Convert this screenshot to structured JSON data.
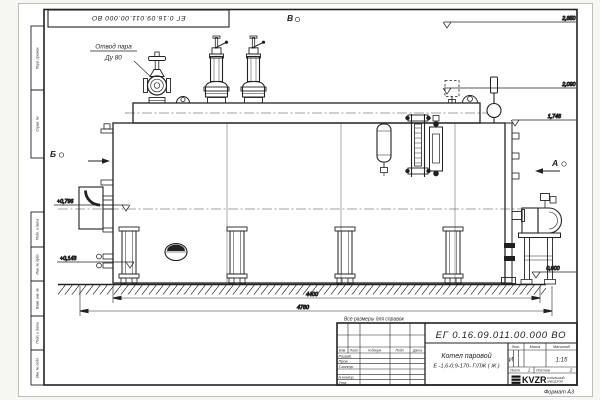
{
  "sheet": {
    "format_label": "Формат А3",
    "note": "Все размеры для справок"
  },
  "callouts": {
    "steam_outlet_line1": "Отвод пара",
    "steam_outlet_line2": "Ду 80"
  },
  "view_markers": {
    "top": "В",
    "left": "Б",
    "right": "А"
  },
  "elevations": {
    "valves_top": "2,850",
    "drum_top": "2,090",
    "shell_top": "1,746",
    "burner_axis": "+0,796",
    "drain": "+0,143",
    "floor": "0,000"
  },
  "dimensions": {
    "boiler_length": "4400",
    "overall_length": "4780"
  },
  "title_block": {
    "doc_number": "ЕГ 0.16.09.011.00.000  ВО",
    "product_line1": "Котел паровой",
    "product_line2": "Е -1,6-0,9-170- Г/ЛЖ ( Ж )",
    "col_headers": {
      "izm": "Изм.",
      "list": "Лист",
      "ndoc": "N докум.",
      "podp": "Подп.",
      "data": "Дата"
    },
    "rows": [
      "Разраб.",
      "Пров.",
      "Т.контр.",
      "",
      "Н.контр.",
      "Утв."
    ],
    "lit_label": "Лит.",
    "mass_label": "Масса",
    "scale_label": "Масштаб",
    "lit_value": "И",
    "scale_value": "1:15",
    "sheet_label": "Лист",
    "sheet_value": "1",
    "sheets_label": "Листов",
    "sheets_value": "2",
    "logo_text": "KVZR",
    "logo_line1": "КОТЕЛЬНЫЙ",
    "logo_line2": "ЗАВОД РЭП"
  },
  "margin_labels": [
    "Перв. примен.",
    "Справ. №",
    "Подп. и дата",
    "Инв. № дубл.",
    "Взам. инв. №",
    "Подп. и дата",
    "Инв. № подл."
  ]
}
